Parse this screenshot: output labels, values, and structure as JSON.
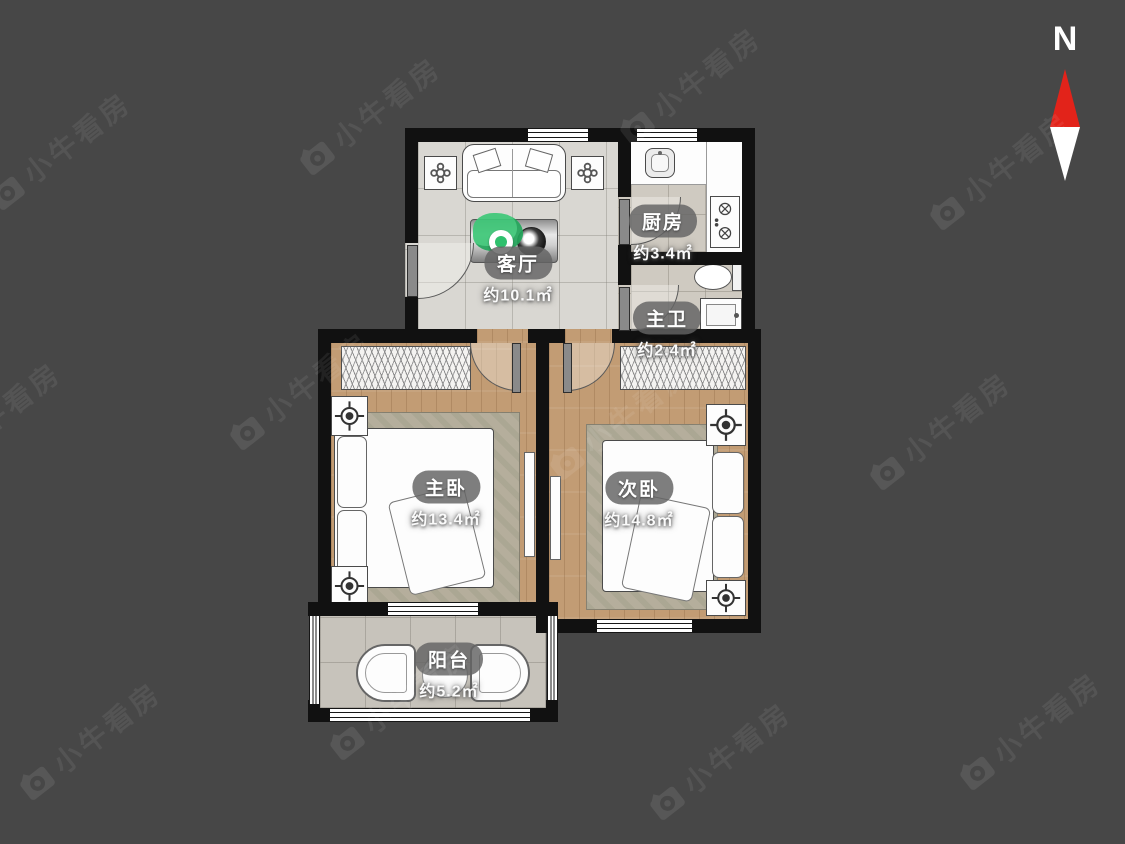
{
  "background": "#474747",
  "compass": {
    "label": "N",
    "red": "#e2231a"
  },
  "watermark": {
    "text": "小牛看房"
  },
  "plan": {
    "wall_color": "#111111",
    "accent_green": "#2fc06d",
    "rooms": {
      "living": {
        "name": "客厅",
        "area": "约10.1㎡"
      },
      "kitchen": {
        "name": "厨房",
        "area": "约3.4㎡"
      },
      "bath": {
        "name": "主卫",
        "area": "约2.4㎡"
      },
      "master": {
        "name": "主卧",
        "area": "约13.4㎡"
      },
      "second": {
        "name": "次卧",
        "area": "约14.8㎡"
      },
      "balcony": {
        "name": "阳台",
        "area": "约5.2㎡"
      }
    }
  }
}
